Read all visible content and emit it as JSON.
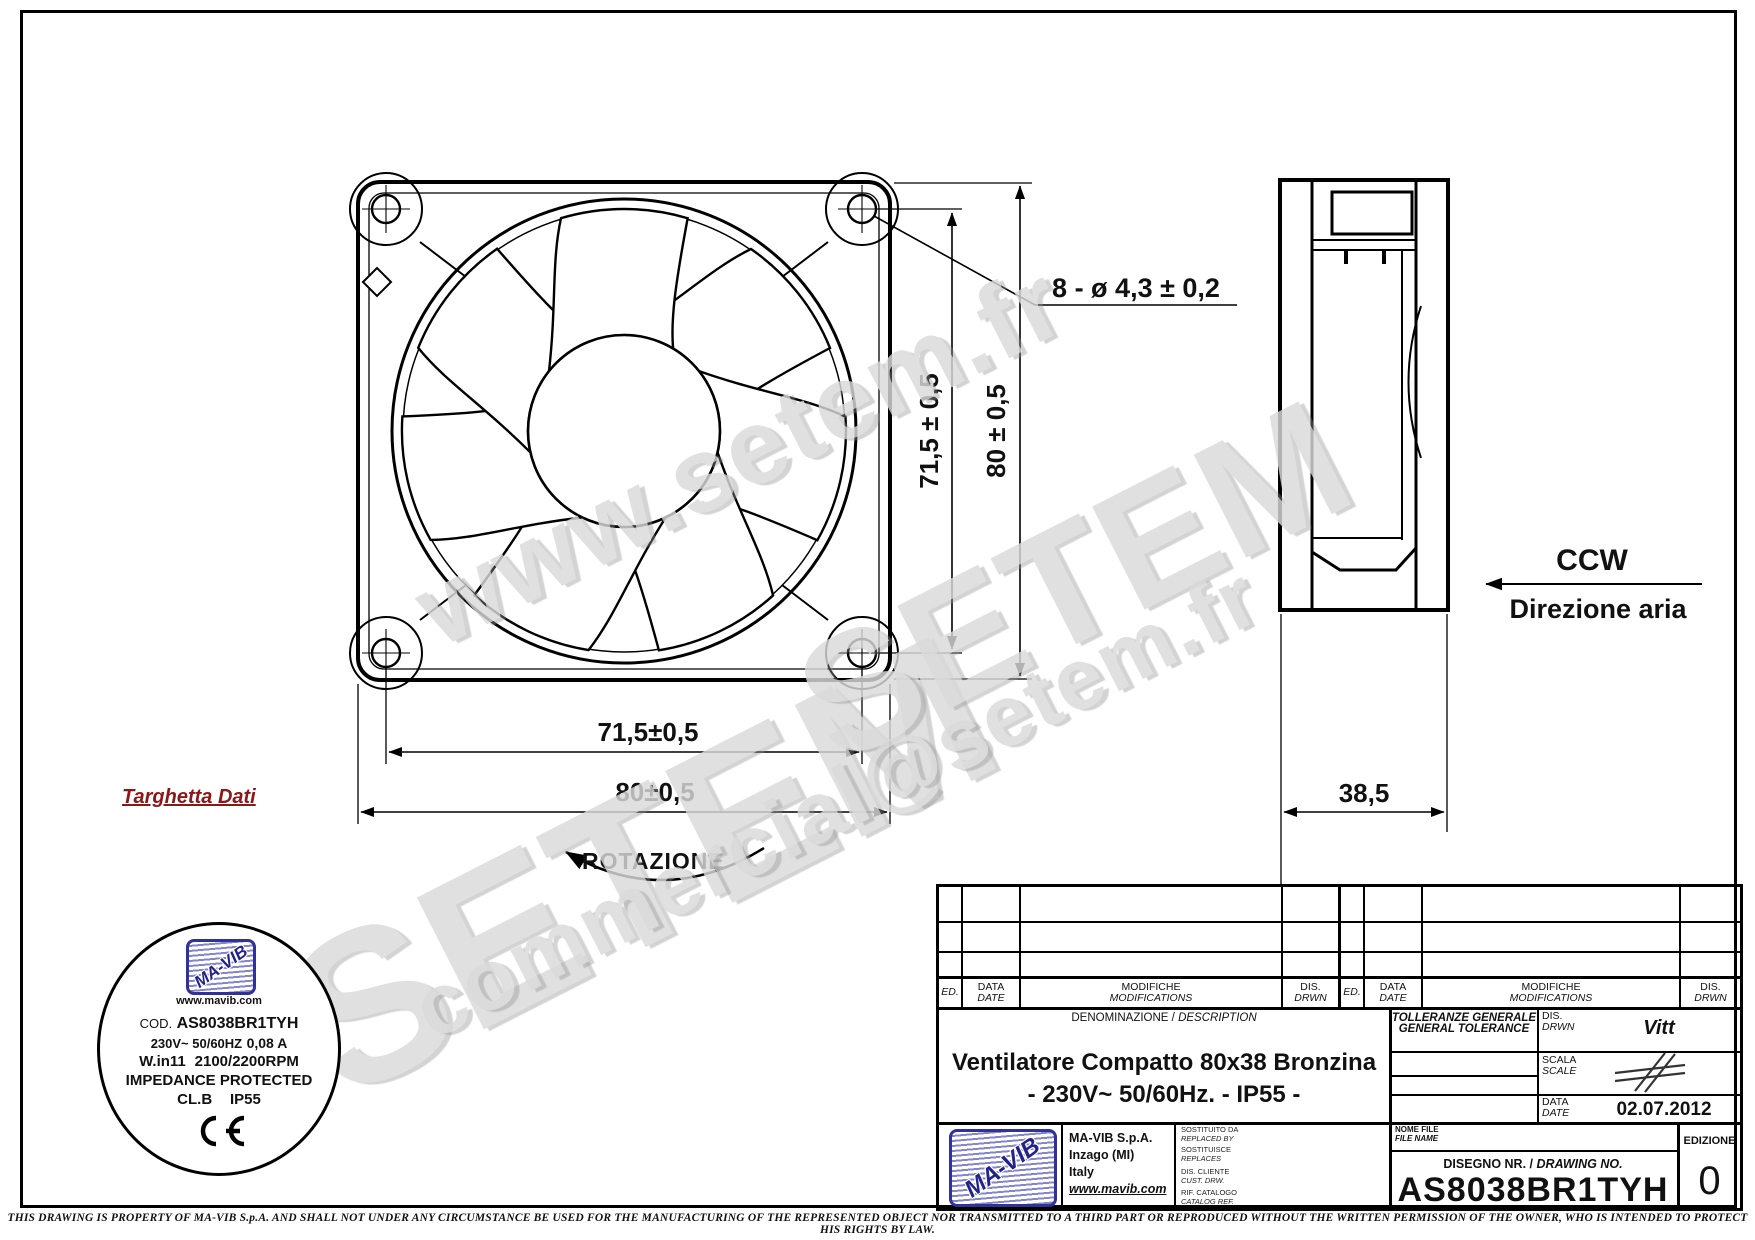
{
  "watermarks": {
    "site": "www.setem.fr",
    "brand_a": "SETEM",
    "brand_b": "SETEM",
    "email": "commercial@setem.fr"
  },
  "front_view": {
    "holes_note": "8 - ø 4,3 ± 0,2",
    "pitch_vertical": "71,5 ± 0,5",
    "size_vertical": "80 ± 0,5",
    "pitch_horizontal": "71,5±0,5",
    "size_horizontal": "80±0,5",
    "rotation_label": "ROTAZIONE"
  },
  "side_view": {
    "depth": "38,5",
    "airflow_code": "CCW",
    "airflow_label": "Direzione aria"
  },
  "data_plate": {
    "caption": "Targhetta Dati",
    "logo_text": "MA-VIB",
    "website": "www.mavib.com",
    "code_label": "COD.",
    "code_value": "AS8038BR1TYH",
    "voltage": "230V~ 50/60HZ",
    "current": "0,08 A",
    "power": "W.in11",
    "speed": "2100/2200RPM",
    "protection": "IMPEDANCE  PROTECTED",
    "insulation_class": "CL.B",
    "ip_rating": "IP55",
    "ce_mark": "CE"
  },
  "title_block": {
    "rev": {
      "ed": "ED.",
      "data": "DATA",
      "date": "DATE",
      "mod_it": "MODIFICHE",
      "mod_en": "MODIFICATIONS",
      "dis": "DIS.",
      "drwn": "DRWN"
    },
    "denom_it": "DENOMINAZIONE /",
    "denom_en": "DESCRIPTION",
    "description_line1": "Ventilatore Compatto 80x38 Bronzina",
    "description_line2": "- 230V~  50/60Hz.  -  IP55  -",
    "tol_it": "TOLLERANZE GENERALE",
    "tol_en": "GENERAL TOLERANCE",
    "dis_label": "DIS.",
    "drwn_label": "DRWN",
    "drawn_by": "Vitt",
    "scala_it": "SCALA",
    "scala_en": "SCALE",
    "date_it": "DATA",
    "date_en": "DATE",
    "date_value": "02.07.2012",
    "company": {
      "logo_text": "MA-VIB",
      "name": "MA-VIB S.p.A.",
      "city": "Inzago (MI)",
      "country": "Italy",
      "website": "www.mavib.com"
    },
    "replaced_it": "SOSTITUITO DA",
    "replaced_en": "REPLACED BY",
    "replaces_it": "SOSTITUISCE",
    "replaces_en": "REPLACES",
    "cust_it": "DIS. CLIENTE",
    "cust_en": "CUST. DRW.",
    "catalog_it": "RIF. CATALOGO",
    "catalog_en": "CATALOG REF.",
    "file_it": "NOME FILE",
    "file_en": "FILE NAME",
    "drawing_no_label_it": "DISEGNO NR. /",
    "drawing_no_label_en": "DRAWING NO.",
    "drawing_no": "AS8038BR1TYH",
    "edition_label": "EDIZIONE",
    "edition_value": "0"
  },
  "footer": {
    "disclaimer": "THIS DRAWING IS PROPERTY OF MA-VIB S.p.A. AND SHALL NOT UNDER ANY CIRCUMSTANCE BE USED FOR THE MANUFACTURING OF THE REPRESENTED OBJECT NOR TRANSMITTED TO A THIRD PART OR REPRODUCED WITHOUT THE WRITTEN PERMISSION OF THE OWNER, WHO IS INTENDED TO PROTECT HIS RIGHTS BY LAW."
  },
  "colors": {
    "accent_red": "#8b1717",
    "logo_blue": "#31319c",
    "watermark_gray": "#dadada"
  }
}
